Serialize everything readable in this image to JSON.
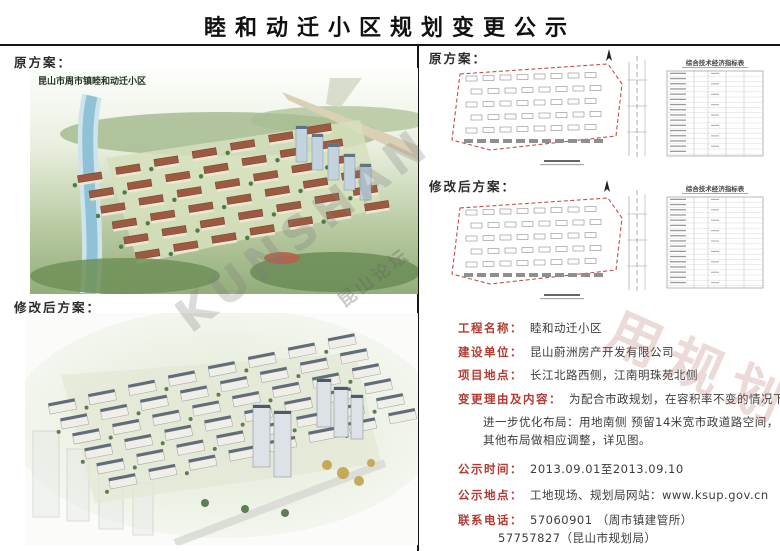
{
  "page": {
    "title": "睦和动迁小区规划变更公示"
  },
  "watermarks": {
    "latin": "KUNSHAN",
    "gray_cn": "昆山论坛",
    "red_cn": "用规划"
  },
  "left": {
    "original_label": "原方案：",
    "modified_label": "修改后方案：",
    "original_caption": "昆山市周市镇睦和动迁小区"
  },
  "right": {
    "original_label": "原方案：",
    "modified_label": "修改后方案：",
    "original_table_title": "综合技术经济指标表",
    "modified_table_title": "综合技术经济指标表"
  },
  "info": {
    "rows": [
      {
        "label": "工程名称：",
        "value": "睦和动迁小区"
      },
      {
        "label": "建设单位：",
        "value": "昆山蔚洲房产开发有限公司"
      },
      {
        "label": "项目地点：",
        "value": "长江北路西侧，江南明珠苑北侧"
      },
      {
        "label": "变更理由及内容：",
        "value": "为配合市政规划，在容积率不变的情况下，"
      }
    ],
    "detail_lines": [
      "进一步优化布局：用地南侧 预留14米宽市政道路空间，",
      "其他布局做相应调整，详见图。"
    ],
    "notice_rows": [
      {
        "label": "公示时间：",
        "value": "2013.09.01至2013.09.10"
      },
      {
        "label": "公示地点：",
        "value": "工地现场、规划局网站：www.ksup.gov.cn"
      },
      {
        "label": "联系电话：",
        "value": "57060901 （周市镇建管所）"
      }
    ],
    "phone_extra": "57757827（昆山市规划局）"
  },
  "colors": {
    "label_red": "#b23b32",
    "boundary_red": "#c0504d",
    "text_dark": "#3c3c3c"
  }
}
